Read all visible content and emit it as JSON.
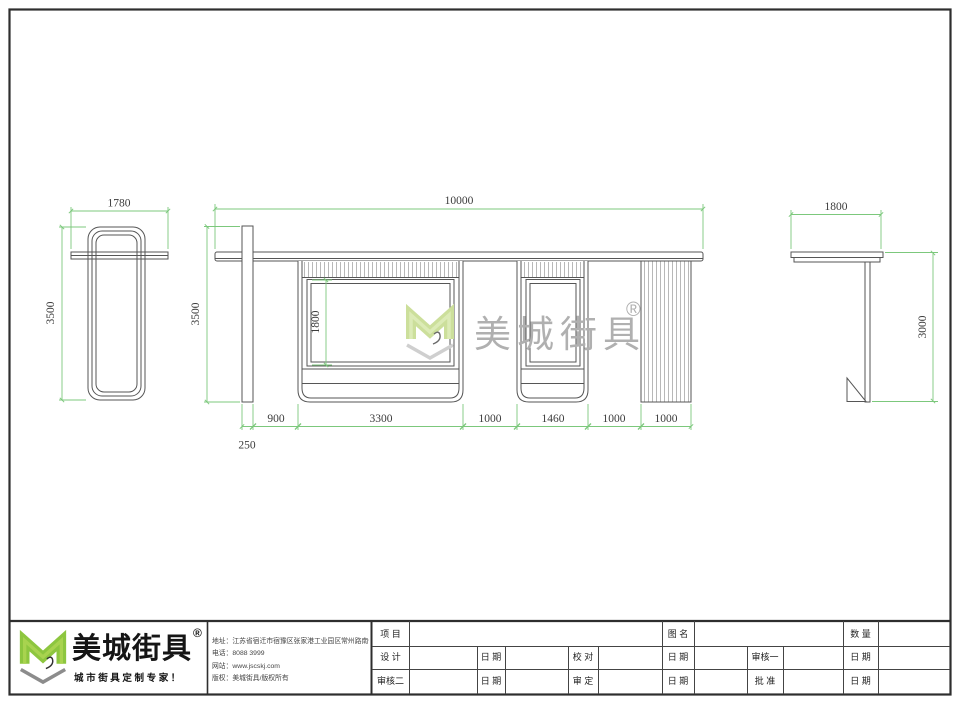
{
  "colors": {
    "dim_line": "#7cc87c",
    "drawing_line": "#565656",
    "logo_green": "#8dc63f",
    "watermark_gray": "#b0b0b0"
  },
  "views": {
    "left_side": {
      "width_dim": "1780",
      "height_dim": "3500"
    },
    "front": {
      "width_dim": "10000",
      "height_dim": "3500",
      "screen_height_dim": "1800",
      "post_width_dim": "250",
      "bottom_dims": [
        "900",
        "3300",
        "1000",
        "1460",
        "1000",
        "1000"
      ]
    },
    "right_side": {
      "width_dim": "1800",
      "height_dim": "3000"
    }
  },
  "watermark": {
    "brand": "美城街具",
    "reg": "®"
  },
  "title_block": {
    "brand": "美城街具",
    "reg": "®",
    "tagline": "城市街具定制专家！",
    "info_lines": [
      "地址：江苏省宿迁市宿豫区张家港工业园区常州路南侧1号",
      "电话：8088 3999",
      "网站：www.jscskj.com",
      "版权：美城街具/版权所有"
    ],
    "table": {
      "r1": [
        "项 目",
        "图 名",
        "数 量"
      ],
      "r2": [
        "设 计",
        "日 期",
        "校 对",
        "日 期",
        "审核一",
        "日 期"
      ],
      "r3": [
        "审核二",
        "日 期",
        "审 定",
        "日 期",
        "批 准",
        "日 期"
      ]
    }
  }
}
